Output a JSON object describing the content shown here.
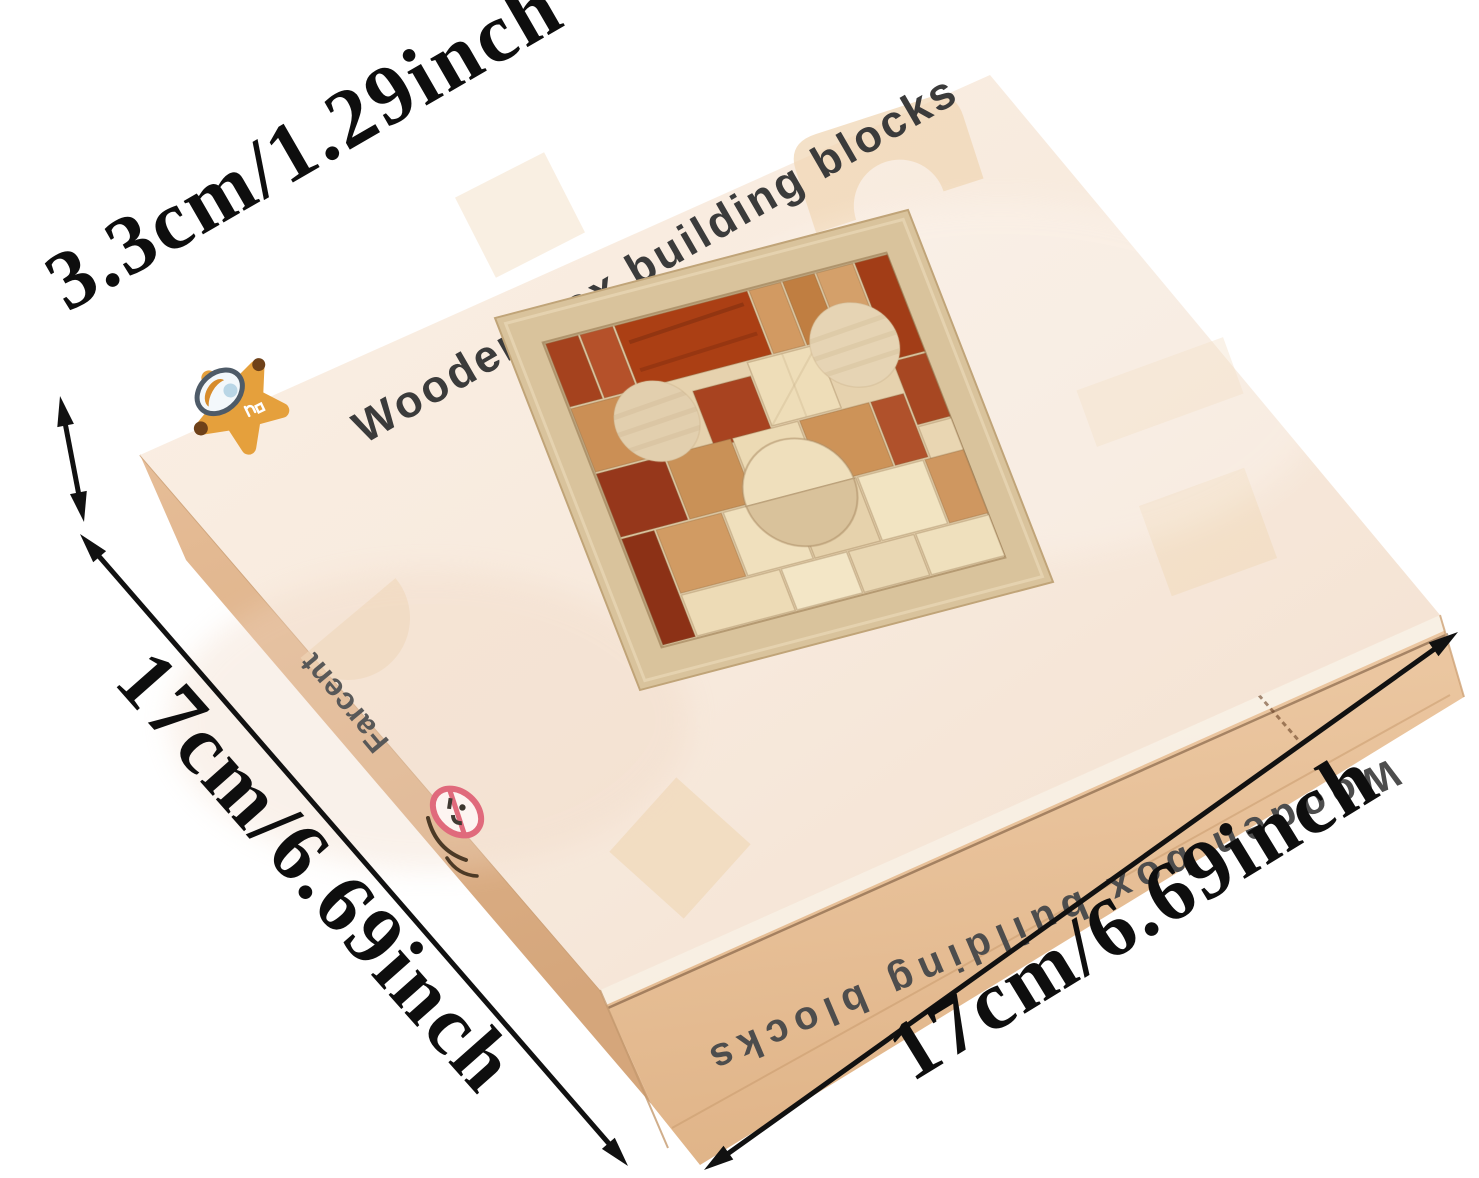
{
  "background_color": "#ffffff",
  "box": {
    "top_title": "Wooden box building blocks",
    "front_side_text": "Wooden box building blocks",
    "left_side_brand": "Farcent",
    "colors": {
      "top_face": "#f7e9dc",
      "cardboard_side": "#e3ba92",
      "tray_frame_wood": "#d9c39c",
      "block_red_brown": "#a8431f",
      "block_tan": "#cd9359",
      "block_cream": "#efdfbd",
      "logo_orange": "#e5a03c",
      "warning_pink": "#e06a7c"
    },
    "icons": {
      "star_logo": "star-mascot-magnifier-icon",
      "age_warning": "age-warning-0-3-icon",
      "handle": "cardboard-handle-slot"
    }
  },
  "annotations": {
    "height_label": "3.3cm/1.29inch",
    "width_left_label": "17cm/6.69inch",
    "width_right_label": "17cm/6.69inch",
    "arrow_color": "#111111"
  }
}
